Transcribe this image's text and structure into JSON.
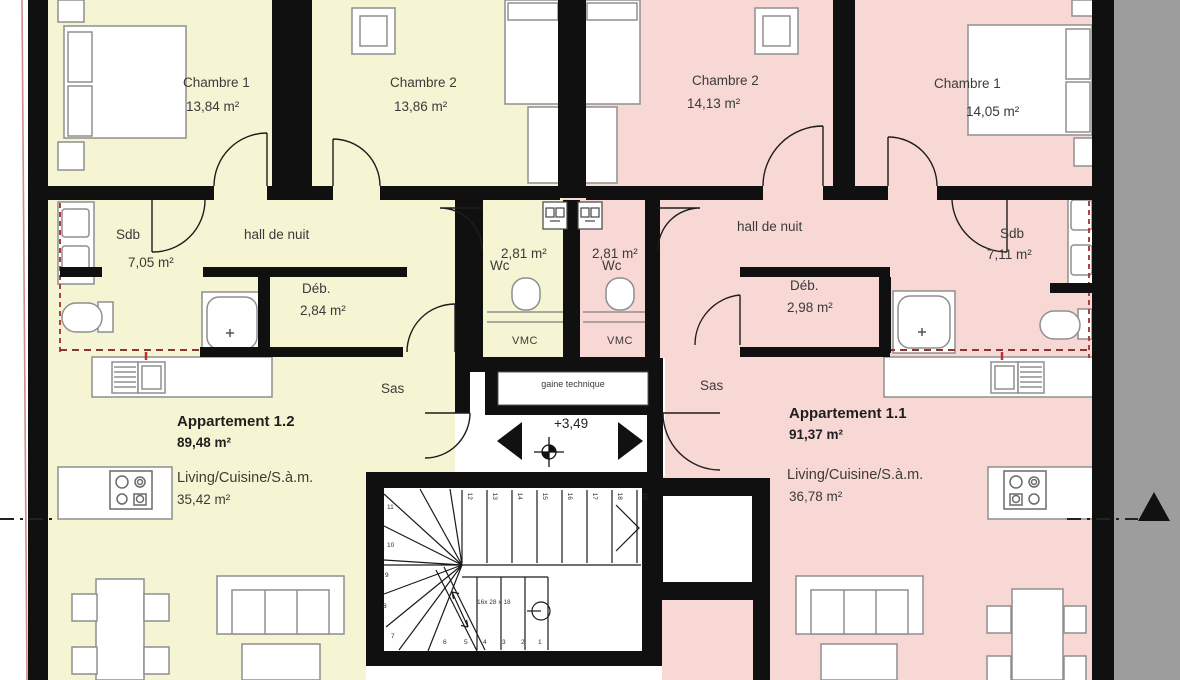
{
  "colors": {
    "apartment_left_fill": "#f6f5d3",
    "apartment_right_fill": "#f8d8d4",
    "wall": "#101010",
    "outside_gray": "#9d9d9d",
    "accent_red": "#b04040",
    "furniture_stroke": "#8f8f8f"
  },
  "left_apartment": {
    "title": "Appartement 1.2",
    "area": "89,48 m²",
    "chambre1": {
      "label": "Chambre 1",
      "area": "13,84 m²"
    },
    "chambre2": {
      "label": "Chambre 2",
      "area": "13,86 m²"
    },
    "sdb": {
      "label": "Sdb",
      "area": "7,05 m²"
    },
    "hall": {
      "label": "hall de nuit"
    },
    "deb": {
      "label": "Déb.",
      "area": "2,84 m²"
    },
    "wc": {
      "label": "Wc",
      "area": "2,81 m²"
    },
    "vmc": {
      "label": "VMC"
    },
    "sas": {
      "label": "Sas"
    },
    "living": {
      "label": "Living/Cuisine/S.à.m.",
      "area": "35,42 m²"
    }
  },
  "right_apartment": {
    "title": "Appartement 1.1",
    "area": "91,37 m²",
    "chambre2": {
      "label": "Chambre 2",
      "area": "14,13 m²"
    },
    "chambre1": {
      "label": "Chambre 1",
      "area": "14,05 m²"
    },
    "sdb": {
      "label": "Sdb",
      "area": "7,11 m²"
    },
    "hall": {
      "label": "hall de nuit"
    },
    "deb": {
      "label": "Déb.",
      "area": "2,98 m²"
    },
    "wc": {
      "label": "Wc",
      "area": "2,81 m²"
    },
    "vmc": {
      "label": "VMC"
    },
    "sas": {
      "label": "Sas"
    },
    "living": {
      "label": "Living/Cuisine/S.à.m.",
      "area": "36,78 m²"
    }
  },
  "core": {
    "gaine": "gaine technique",
    "level": "+3,49",
    "stair_note": "16x 28 x 18",
    "winder_numbers": [
      "11",
      "10",
      "9",
      "8",
      "7"
    ],
    "upper_numbers": [
      "12",
      "13",
      "14",
      "15",
      "16",
      "17",
      "18",
      "19"
    ],
    "lower_numbers": [
      "6",
      "5",
      "4",
      "3",
      "2",
      "1"
    ]
  }
}
